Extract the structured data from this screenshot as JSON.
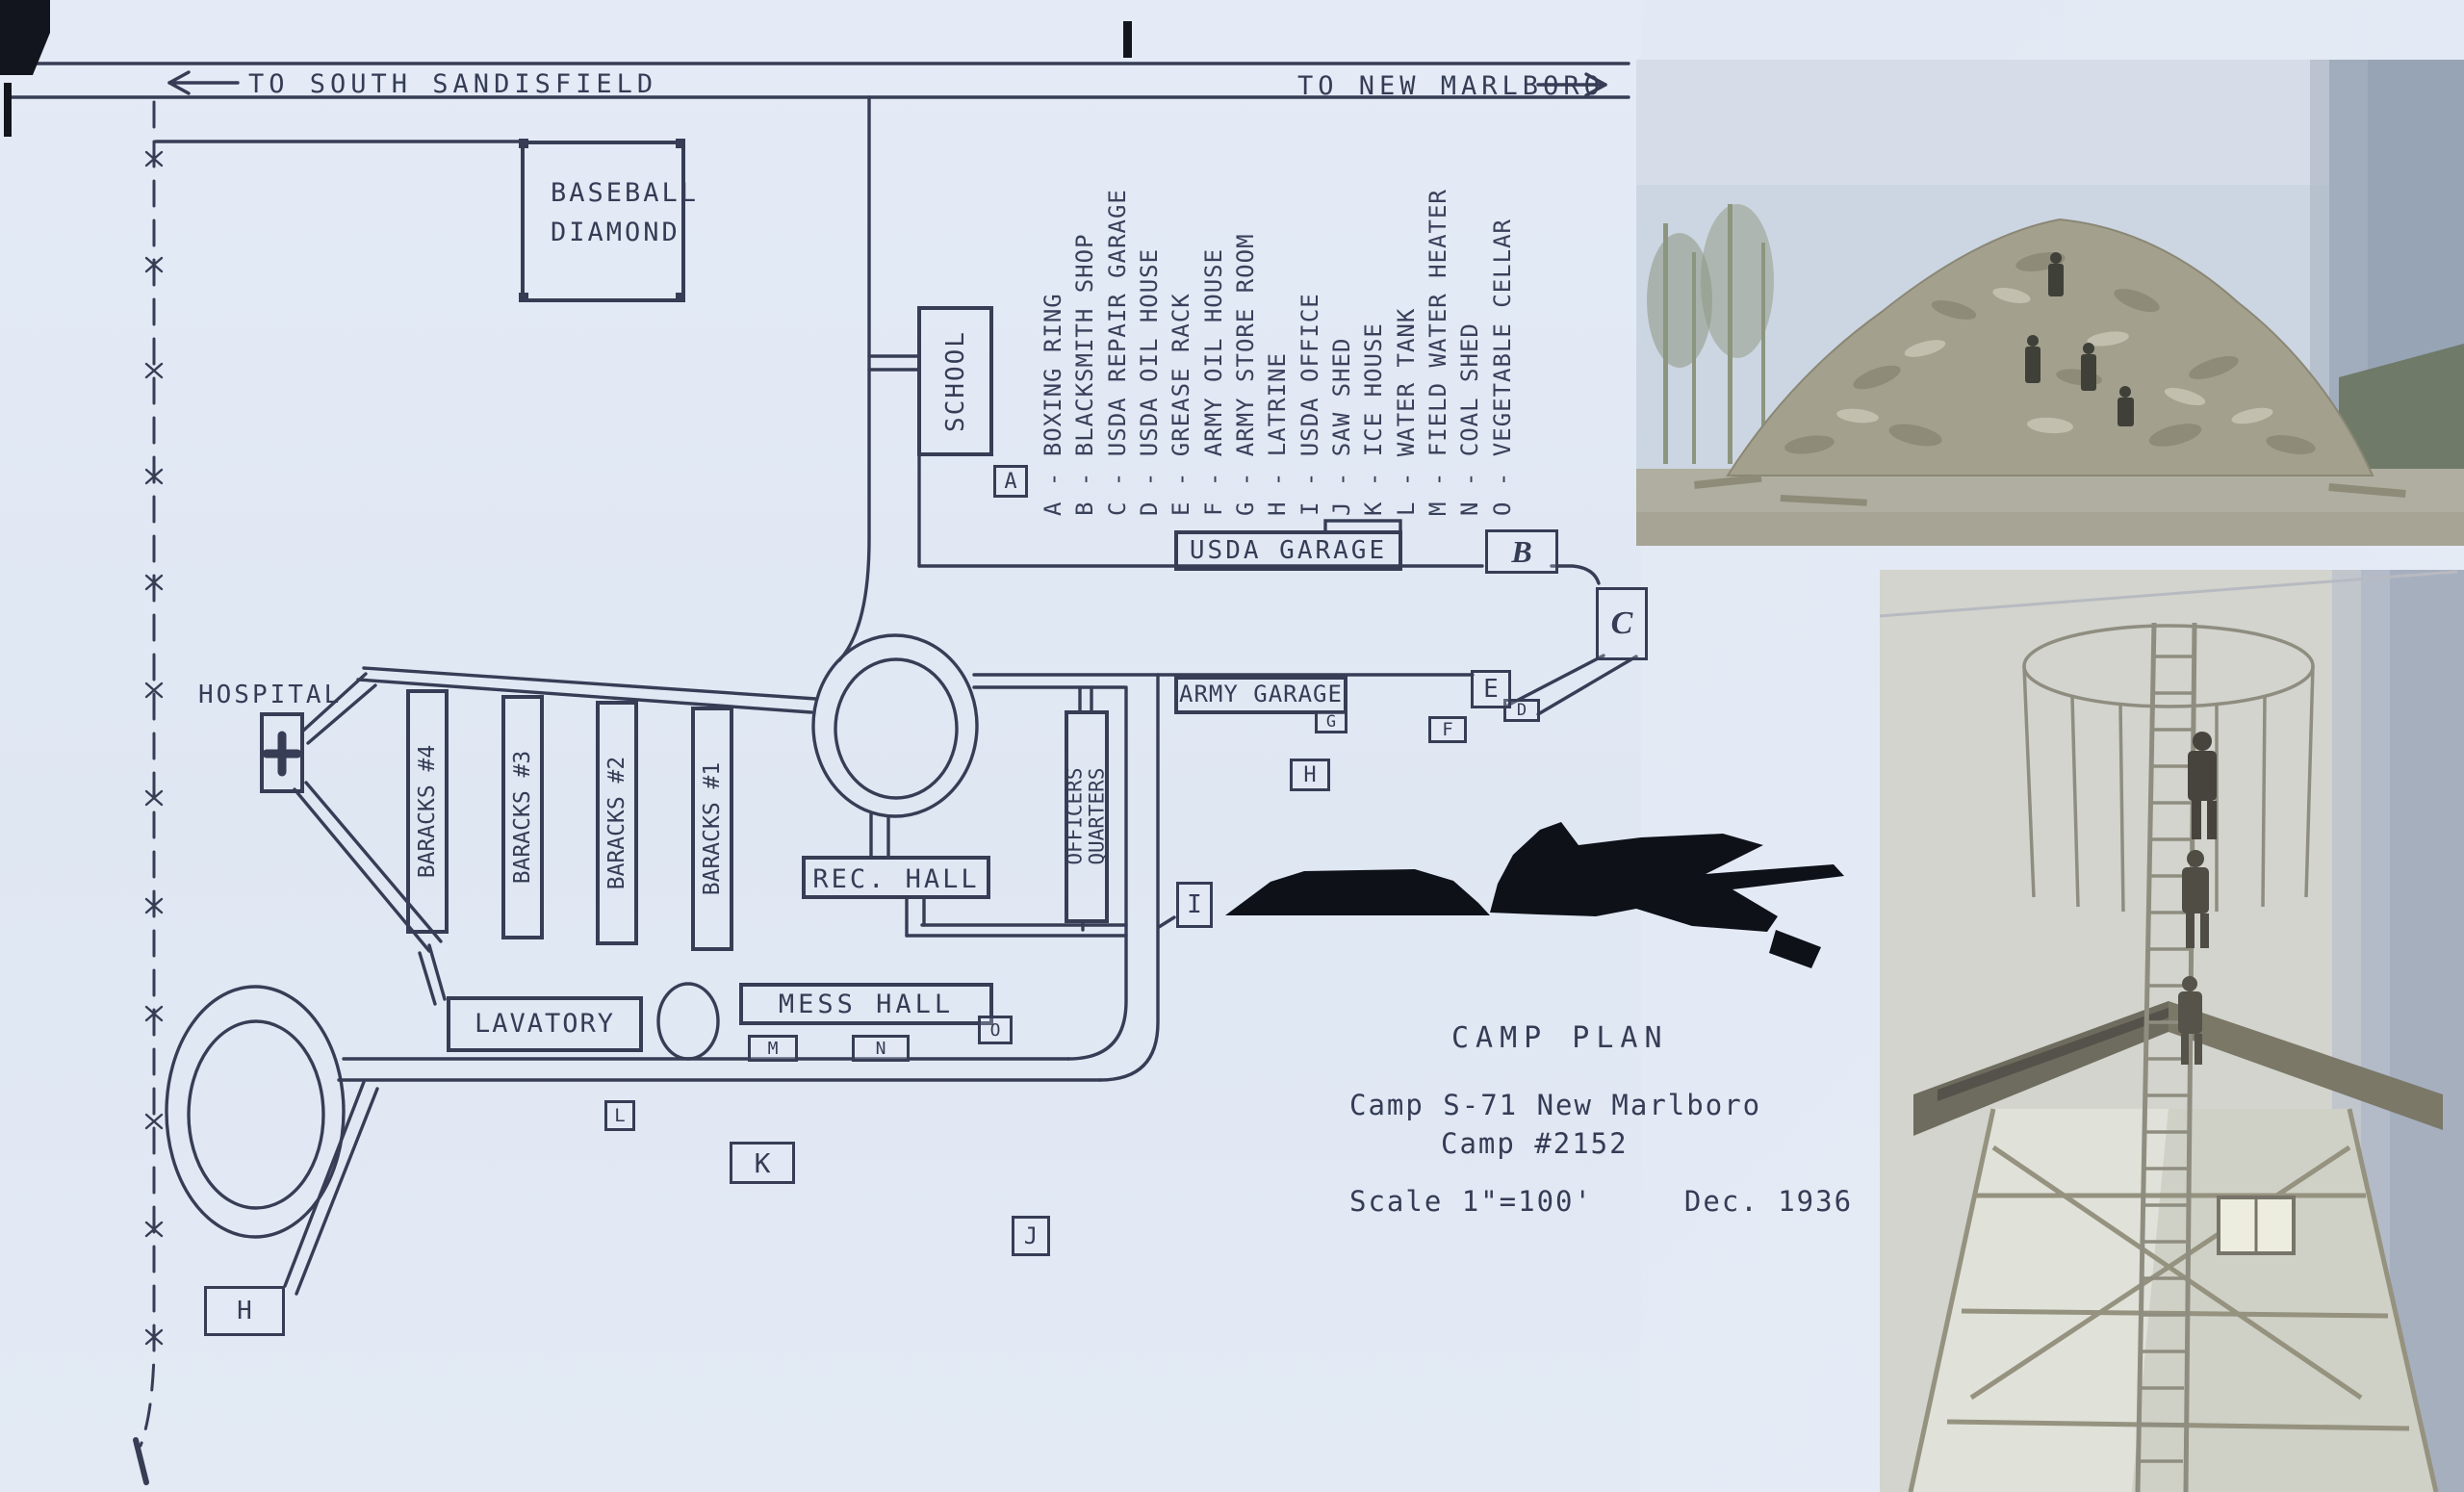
{
  "road_signs": {
    "left": {
      "text": "TO SOUTH SANDISFIELD",
      "arrow": "left"
    },
    "right": {
      "text": "TO NEW MARLBORO",
      "arrow": "right"
    }
  },
  "legend": {
    "items": [
      {
        "letter": "A",
        "name": "BOXING RING",
        "text": "A - BOXING RING"
      },
      {
        "letter": "B",
        "name": "BLACKSMITH SHOP",
        "text": "B - BLACKSMITH SHOP"
      },
      {
        "letter": "C",
        "name": "USDA REPAIR GARAGE",
        "text": "C - USDA REPAIR GARAGE"
      },
      {
        "letter": "D",
        "name": "USDA OIL HOUSE",
        "text": "D - USDA OIL HOUSE"
      },
      {
        "letter": "E",
        "name": "GREASE RACK",
        "text": "E - GREASE RACK"
      },
      {
        "letter": "F",
        "name": "ARMY OIL HOUSE",
        "text": "F - ARMY OIL HOUSE"
      },
      {
        "letter": "G",
        "name": "ARMY STORE ROOM",
        "text": "G - ARMY STORE ROOM"
      },
      {
        "letter": "H",
        "name": "LATRINE",
        "text": "H - LATRINE"
      },
      {
        "letter": "I",
        "name": "USDA OFFICE",
        "text": "I - USDA OFFICE"
      },
      {
        "letter": "J",
        "name": "SAW SHED",
        "text": "J - SAW SHED"
      },
      {
        "letter": "K",
        "name": "ICE HOUSE",
        "text": "K - ICE HOUSE"
      },
      {
        "letter": "L",
        "name": "WATER TANK",
        "text": "L - WATER TANK"
      },
      {
        "letter": "M",
        "name": "FIELD WATER HEATER",
        "text": "M - FIELD WATER HEATER"
      },
      {
        "letter": "N",
        "name": "COAL SHED",
        "text": "N - COAL SHED"
      },
      {
        "letter": "O",
        "name": "VEGETABLE CELLAR",
        "text": "O - VEGETABLE CELLAR"
      }
    ]
  },
  "buildings": {
    "baseball_line1": "BASEBALL",
    "baseball_line2": "DIAMOND",
    "school": "SCHOOL",
    "hospital": "HOSPITAL",
    "barracks": [
      "BARACKS #4",
      "BARACKS #3",
      "BARACKS #2",
      "BARACKS #1"
    ],
    "rec_hall": "REC. HALL",
    "lavatory": "LAVATORY",
    "mess_hall": "MESS HALL",
    "officers_line1": "OFFICERS",
    "officers_line2": "QUARTERS",
    "usda_garage": "USDA GARAGE",
    "army_garage": "ARMY GARAGE"
  },
  "markers": [
    {
      "letter": "A"
    },
    {
      "letter": "B"
    },
    {
      "letter": "C"
    },
    {
      "letter": "D"
    },
    {
      "letter": "E"
    },
    {
      "letter": "F"
    },
    {
      "letter": "G"
    },
    {
      "letter": "H"
    },
    {
      "letter": "I"
    },
    {
      "letter": "J"
    },
    {
      "letter": "K"
    },
    {
      "letter": "L"
    },
    {
      "letter": "M"
    },
    {
      "letter": "N"
    },
    {
      "letter": "O"
    },
    {
      "letter": "H"
    }
  ],
  "title_block": {
    "title": "CAMP PLAN",
    "camp_line": "Camp S-71 New Marlboro",
    "camp_number": "Camp #2152",
    "scale": "Scale 1\"=100'",
    "date": "Dec. 1936"
  },
  "colors": {
    "ink": "#363d55",
    "paper": "#e3eaf5",
    "photo_sky": "#ccd6e2",
    "photo_sepia": "#a3a08e",
    "ink_blot": "#0e1118"
  }
}
